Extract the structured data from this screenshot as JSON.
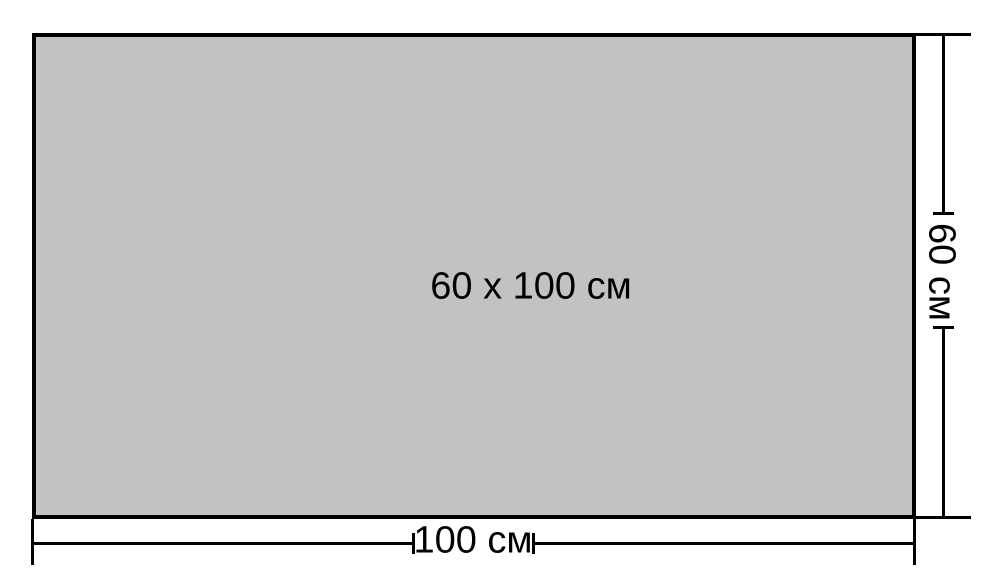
{
  "diagram": {
    "center_label": "60 x 100 см",
    "width_dimension": {
      "label": "100 см"
    },
    "height_dimension": {
      "label": "60 см"
    },
    "colors": {
      "fill": "#c2c2c2",
      "line": "#000000",
      "background": "#ffffff"
    }
  }
}
